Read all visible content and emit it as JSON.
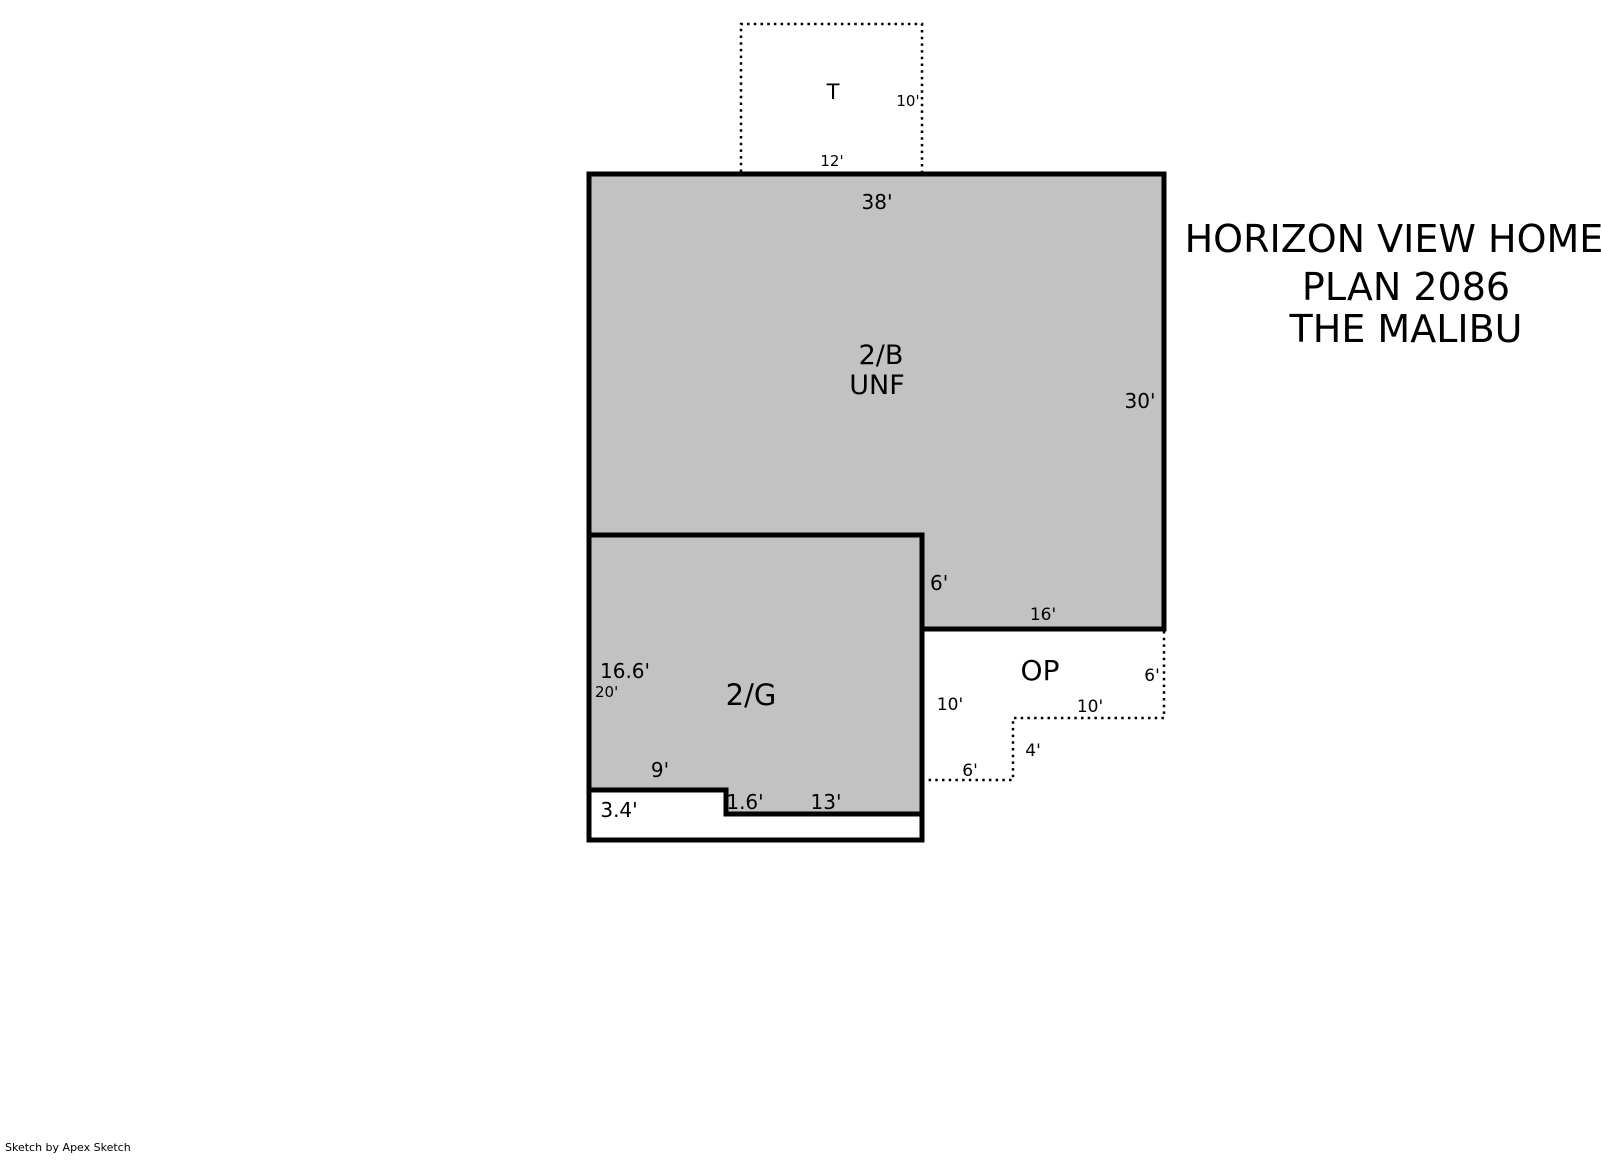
{
  "colors": {
    "area_fill": "#c2c2c2",
    "outline": "#000000",
    "background": "#ffffff"
  },
  "title_block": {
    "line1": "HORIZON VIEW HOMES",
    "line2": "PLAN 2086",
    "line3": "THE MALIBU"
  },
  "credit": "Sketch by Apex Sketch",
  "rooms": {
    "basement": {
      "label": "2/B",
      "sublabel": "UNF"
    },
    "garage": {
      "label": "2/G"
    },
    "open_porch": {
      "label": "OP"
    },
    "terrace": {
      "label": "T"
    }
  },
  "dimensions": {
    "terrace_right": "10'",
    "terrace_bottom": "12'",
    "basement_top": "38'",
    "basement_right": "30'",
    "garage_right_upper": "6'",
    "porch_top": "16'",
    "garage_left_interior": "16.6'",
    "garage_left_overall": "20'",
    "porch_left": "10'",
    "porch_mid": "10'",
    "porch_right": "6'",
    "porch_step": "4'",
    "porch_bottom": "6'",
    "garage_notch_top": "9'",
    "garage_notch_height": "3.4'",
    "garage_step": "1.6'",
    "garage_bottom": "13'"
  }
}
